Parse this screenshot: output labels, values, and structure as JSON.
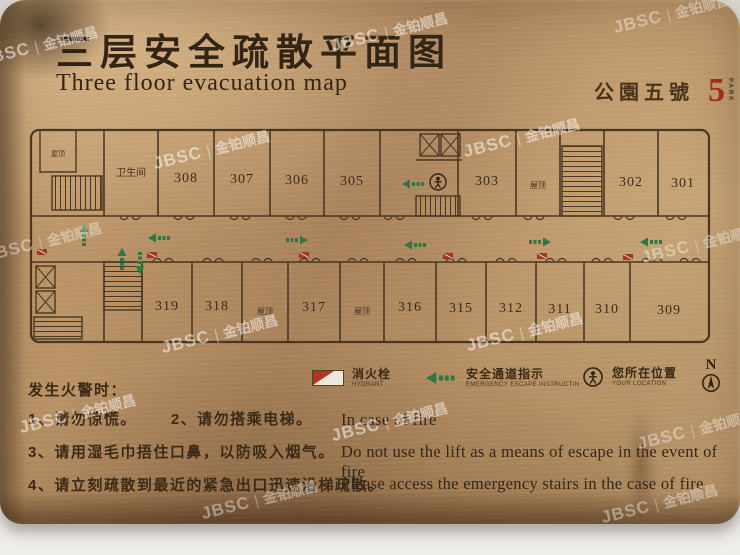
{
  "title": {
    "zh": "三层安全疏散平面图",
    "en": "Three floor evacuation map"
  },
  "brand": {
    "zh": "公園五號",
    "number": "5",
    "vertical": "PARK"
  },
  "watermark": {
    "brand": "JBSC",
    "divider": "|",
    "name": "金铂顺昌"
  },
  "plan": {
    "top_rooms": [
      "屋顶",
      "卫生间",
      "308",
      "307",
      "306",
      "305",
      "303",
      "屋顶",
      "302",
      "301"
    ],
    "bottom_rooms": [
      "319",
      "318",
      "屋顶",
      "317",
      "屋顶",
      "316",
      "315",
      "312",
      "311",
      "310",
      "309"
    ]
  },
  "legend": {
    "hydrant": {
      "zh": "消火栓",
      "en": "HYDRANT"
    },
    "escape": {
      "zh": "安全通道指示",
      "en": "EMERGENCY ESCAPE INSTRUCTIN"
    },
    "location": {
      "zh": "您所在位置",
      "en": "YOUR LOCATION"
    },
    "north": "N"
  },
  "instructions": {
    "heading": "发生火警时：",
    "zh": [
      "1、请勿惊慌。",
      "2、请勿搭乘电梯。",
      "3、请用湿毛巾捂住口鼻，以防吸入烟气。",
      "4、请立刻疏散到最近的紧急出口迅速沿梯疏散。"
    ],
    "en": [
      "In case of fire",
      "Do not use the lift as a means of escape in the event of fire",
      "Please access the emergency stairs in the case of fire"
    ]
  }
}
